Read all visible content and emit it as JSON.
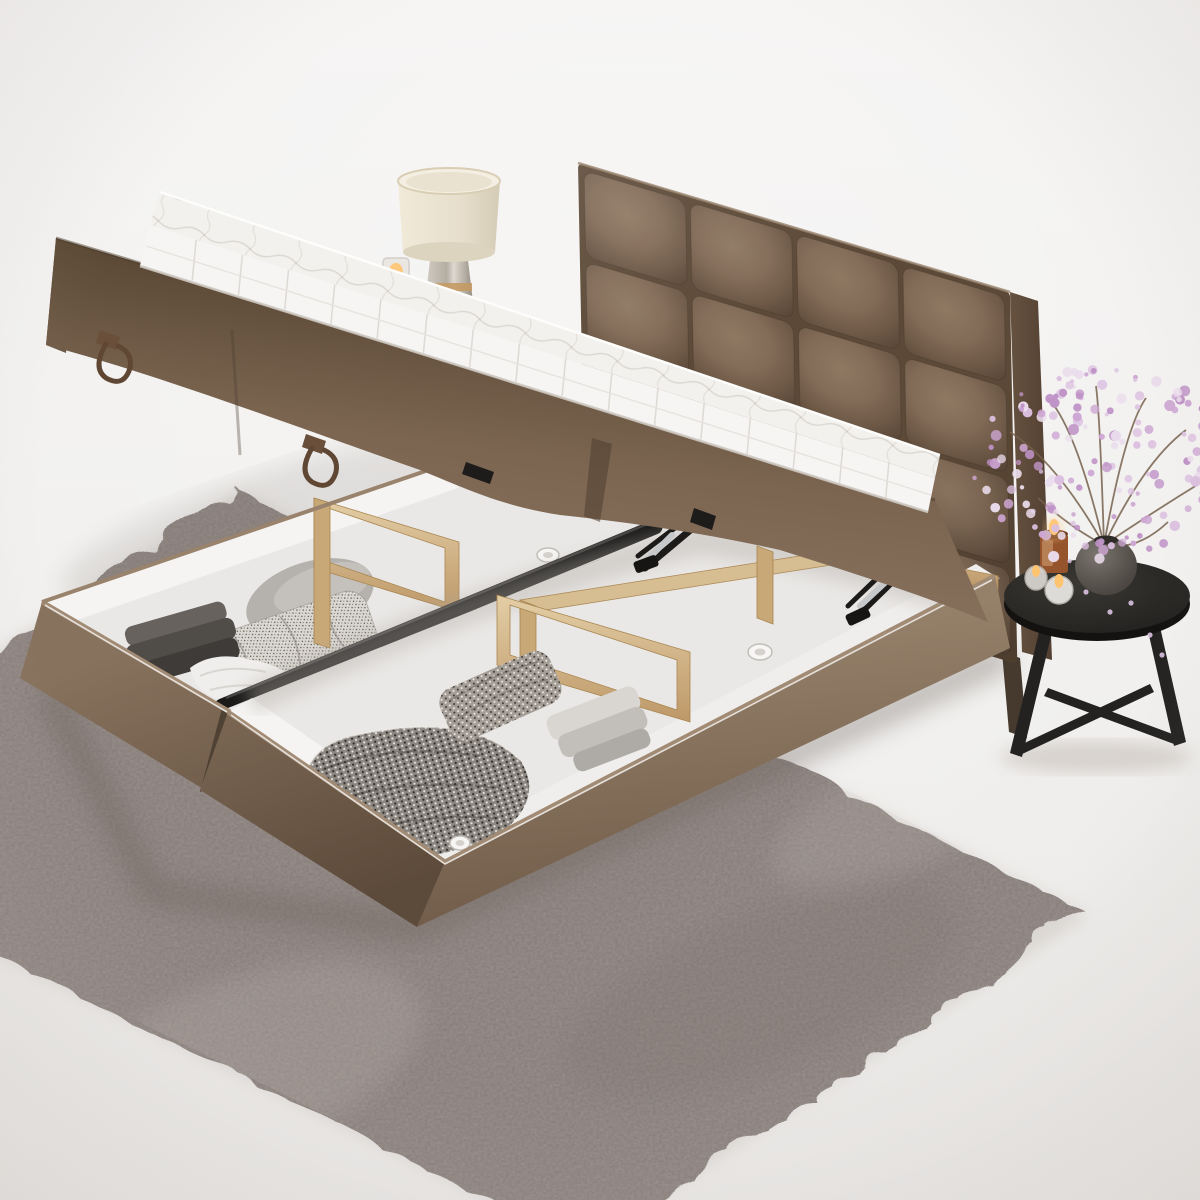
{
  "meta": {
    "title": "Ottoman storage bed with lifted mattress platform — studio product render",
    "canvas": {
      "width": 1200,
      "height": 1200
    },
    "setting": "bright minimal bedroom corner, white seamless studio backdrop"
  },
  "palette": {
    "bg_top": "#f4f3f2",
    "bg_bottom": "#e9e7e5",
    "rug_base": "#9c938f",
    "rug_light": "#c6bdb8",
    "rug_dark": "#5f5752",
    "velvet_light": "#97816c",
    "velvet_mid": "#836c58",
    "velvet_dark": "#5f4c3c",
    "mattress_white": "#f6f5f3",
    "quilt_line": "#d9d5cf",
    "interior_white": "#eae8e6",
    "interior_bright": "#f5f4f2",
    "wood_light": "#e2cca3",
    "wood_dark": "#b3905f",
    "steel_black": "#1b1a19",
    "chrome": "#c6c8ca",
    "table_black": "#262524",
    "vase_stone": "#615c57",
    "candle_amber": "#95542b",
    "flame": "#ffc470",
    "leather": "#5f4733",
    "lamp_shade": "#eae3d2",
    "lamp_glass": "#c3beb5",
    "brass": "#c49a63",
    "branch": "#77624d"
  },
  "objects": {
    "bed": {
      "label": "brown velvet ottoman storage bed, side-opening, platform raised",
      "headboard": {
        "label": "square-tufted velvet headboard",
        "tufted_grid": "4x4"
      },
      "platform": {
        "label": "gas-lift mattress platform, open",
        "underside": "two brown velvet panels",
        "handles": "two leather pull loops"
      },
      "mattress": {
        "label": "white quilted mattress with pillow-top"
      },
      "storage": {
        "label": "twin white storage compartments",
        "divider": "black steel centre rail",
        "frame": "natural pine beams and posts",
        "lift_hardware": "two black scissor hinges with chrome gas struts",
        "vents": "round ventilation grommets"
      },
      "contents_left": [
        "folded dark-grey throws",
        "speckled cushion",
        "grey cushion",
        "white duvet"
      ],
      "contents_right": [
        "chunky knit blanket",
        "folded knit throw",
        "folded grey linens"
      ]
    },
    "rug": {
      "label": "large grey shag rug, laid diagonally"
    },
    "side_table": {
      "label": "round black metal side table with angled truss legs"
    },
    "vase": {
      "label": "round dark stone vase"
    },
    "flowers": {
      "label": "lilac cherry-blossom branches",
      "colors": [
        "#dcc0e0",
        "#cda6d3",
        "#eadcec",
        "#bf93c7"
      ]
    },
    "candles": {
      "label": "lit amber jar candle and two glass tealights"
    },
    "lamp": {
      "label": "table lamp, cream drum shade on smoked-glass base with brass ring"
    },
    "tealight_floor": {
      "label": "small lit glass candle beside lamp"
    }
  }
}
